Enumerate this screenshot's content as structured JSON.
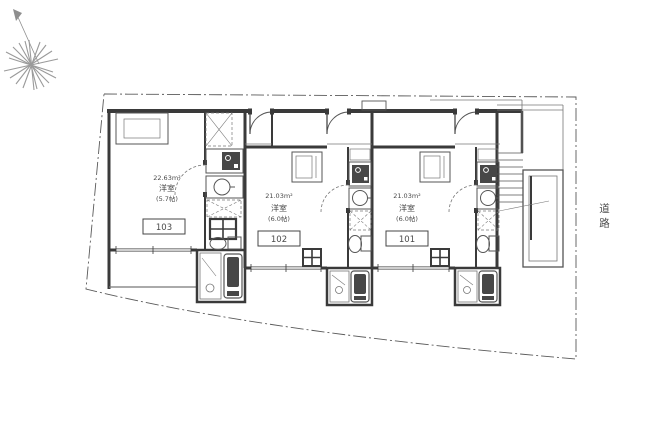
{
  "plan": {
    "road_label": "道路",
    "units": [
      {
        "number": "103",
        "area": "22.63m²",
        "room_type": "洋室",
        "tatami": "(5.7帖)"
      },
      {
        "number": "102",
        "area": "21.03m²",
        "room_type": "洋室",
        "tatami": "(6.0帖)"
      },
      {
        "number": "101",
        "area": "21.03m²",
        "room_type": "洋室",
        "tatami": "(6.0帖)"
      }
    ],
    "icons": {
      "compass": "north-compass-icon",
      "stairs": "staircase",
      "fixtures": [
        "kitchen-sink-icon",
        "washbasin-icon",
        "toilet-icon",
        "bathtub-icon",
        "washing-machine-icon",
        "washer-pan-icon"
      ]
    },
    "colors": {
      "wall": "#3a3a3a",
      "thin_line": "#777777",
      "dark_fill": "#474747",
      "boundary": "#5a5a5a",
      "text": "#4a4a4a",
      "background": "#ffffff"
    }
  }
}
